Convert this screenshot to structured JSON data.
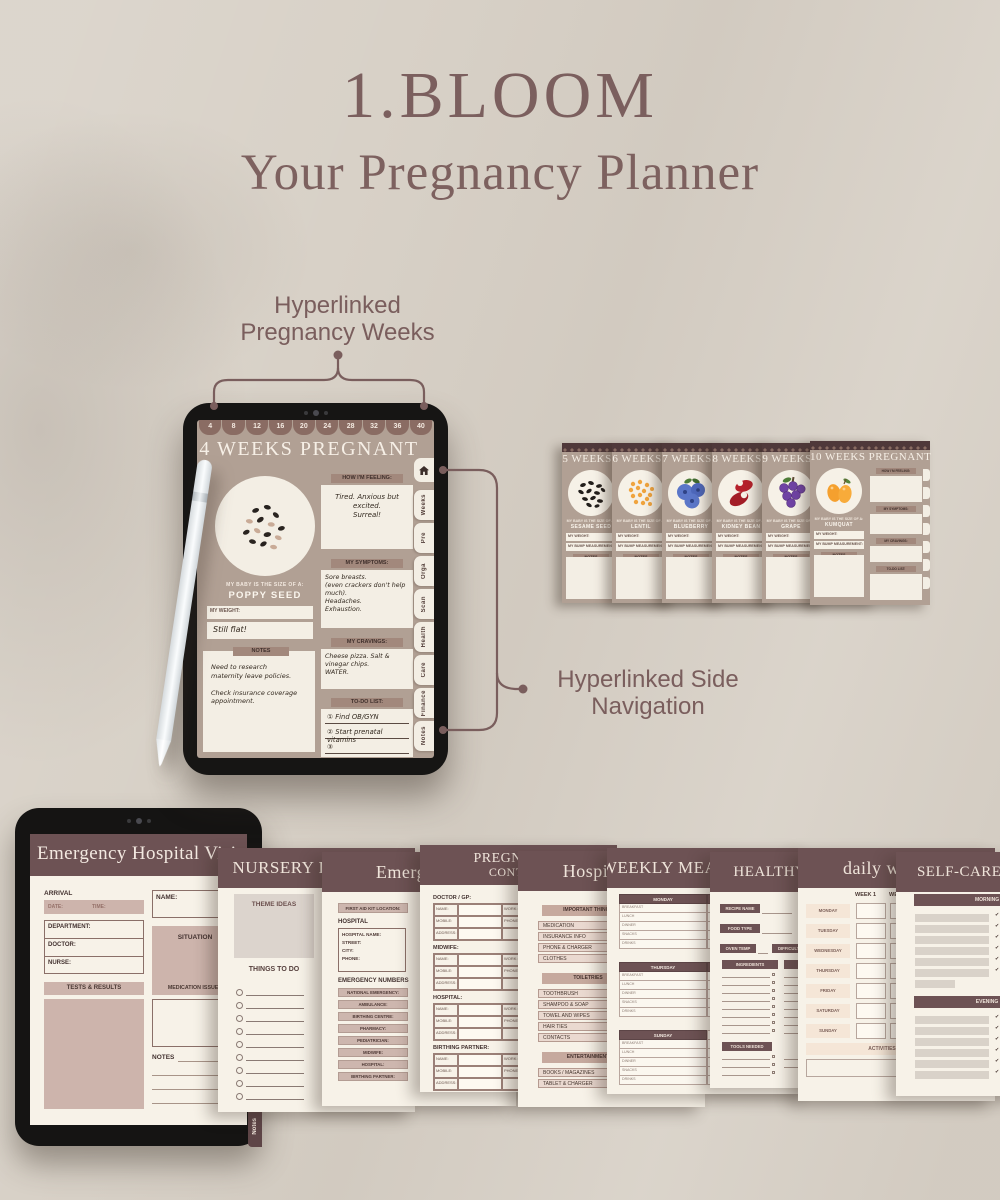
{
  "canvas": {
    "background": "#d8d1c7",
    "accent": "#7b5f5e"
  },
  "header": {
    "title": "1.BLOOM",
    "subtitle": "Your Pregnancy Planner"
  },
  "annotations": {
    "weeks": {
      "line1": "Hyperlinked",
      "line2": "Pregnancy Weeks"
    },
    "sidenav": {
      "line1": "Hyperlinked Side",
      "line2": "Navigation"
    }
  },
  "week_tablet": {
    "week_tabs": [
      "4",
      "8",
      "12",
      "16",
      "20",
      "24",
      "28",
      "32",
      "36",
      "40"
    ],
    "title": "4 WEEKS PREGNANT",
    "size_caption": "MY BABY IS THE SIZE OF A:",
    "size_value": "POPPY SEED",
    "weight_label": "MY WEIGHT:",
    "weight_note": "Still flat!",
    "notes_label": "NOTES",
    "notes_note": "Need to research\nmaternity leave policies.\n\nCheck insurance coverage\nappointment.",
    "feeling_label": "HOW I'M FEELING:",
    "feeling_note": "Tired. Anxious but excited.\nSurreal!",
    "symptoms_label": "MY SYMPTOMS:",
    "symptoms_note": "Sore breasts.\n(even crackers don't help much).\nHeadaches.\nExhaustion.",
    "cravings_label": "MY CRAVINGS:",
    "cravings_note": "Cheese pizza. Salt & vinegar chips.\nWATER.",
    "todo_label": "TO-DO LIST:",
    "todo_items": [
      "① Find OB/GYN",
      "② Start prenatal vitamins",
      "③"
    ],
    "side_tabs": [
      "Weeks",
      "Pre",
      "Orga",
      "Scan",
      "Health",
      "Care",
      "Finance",
      "Notes"
    ]
  },
  "week_cards": {
    "size_caption": "MY BABY IS THE SIZE OF A:",
    "weight_label": "MY WEIGHT:",
    "measure_label": "MY BUMP MEASUREMENT:",
    "notes_label": "NOTES",
    "cards": [
      {
        "title": "5 WEEKS PREGNANT",
        "size": "SESAME SEED"
      },
      {
        "title": "6 WEEKS PREGNANT",
        "size": "LENTIL"
      },
      {
        "title": "7 WEEKS PREGNANT",
        "size": "BLUEBERRY"
      },
      {
        "title": "8 WEEKS PREGNANT",
        "size": "KIDNEY BEAN"
      },
      {
        "title": "9 WEEKS PREGNANT",
        "size": "GRAPE"
      },
      {
        "title": "10 WEEKS PREGNANT",
        "size": "KUMQUAT"
      }
    ]
  },
  "emergency_tablet": {
    "title": "Emergency Hospital Visit",
    "arrival_label": "ARRIVAL",
    "date_label": "DATE:",
    "time_label": "TIME:",
    "fields": [
      "DEPARTMENT:",
      "DOCTOR:",
      "NURSE:"
    ],
    "name_label": "NAME:",
    "situation_label": "SITUATION",
    "tests_label": "TESTS & RESULTS",
    "medication_label": "MEDICATION ISSUED",
    "notes_label": "NOTES",
    "side_tab": "Notes"
  },
  "pages": {
    "nursery": {
      "title": "NURSERY PLANNER",
      "theme_label": "THEME IDEAS",
      "todo_label": "THINGS TO DO"
    },
    "emergency": {
      "title": "Emergency",
      "first_aid_label": "FIRST AID KIT LOCATION:",
      "hospital_label": "HOSPITAL",
      "hospital_fields": [
        "HOSPITAL NAME:",
        "STREET:",
        "CITY:",
        "PHONE:"
      ],
      "numbers_label": "EMERGENCY NUMBERS",
      "numbers": [
        "NATIONAL EMERGENCY:",
        "AMBULANCE:",
        "BIRTHING CENTRE:",
        "PHARMACY:",
        "PEDIATRICIAN:",
        "MIDWIFE:",
        "HOSPITAL:",
        "BIRTHING PARTNER:"
      ]
    },
    "contacts": {
      "title_line1": "PREGNANCY",
      "title_line2": "CONTACT",
      "sections": [
        "DOCTOR / GP:",
        "MIDWIFE:",
        "HOSPITAL:",
        "BIRTHING PARTNER:"
      ],
      "row_labels": [
        "NAME:",
        "MOBILE:",
        "ADDRESS:"
      ],
      "right_labels": [
        "WORK:",
        "PHONE:"
      ]
    },
    "hospital_bag": {
      "title": "Hospital bag",
      "groups": [
        {
          "label": "IMPORTANT THINGS",
          "items": [
            "MEDICATION",
            "INSURANCE INFO",
            "PHONE & CHARGER",
            "CLOTHES"
          ]
        },
        {
          "label": "TOILETRIES",
          "items": [
            "TOOTHBRUSH",
            "SHAMPOO & SOAP",
            "TOWEL AND WIPES",
            "HAIR TIES",
            "CONTACTS"
          ]
        },
        {
          "label": "ENTERTAINMENT",
          "items": [
            "BOOKS / MAGAZINES",
            "TABLET & CHARGER"
          ]
        }
      ]
    },
    "weekly_meal": {
      "title": "WEEKLY MEAL PLANNER",
      "day_pairs": [
        [
          "MONDAY",
          "TUESDAY"
        ],
        [
          "THURSDAY",
          "FRIDAY"
        ],
        [
          "SUNDAY",
          ""
        ]
      ],
      "rows": [
        "BREAKFAST",
        "LUNCH",
        "DINNER",
        "SNACKS",
        "DRINKS"
      ]
    },
    "recipes": {
      "title": "HEALTHY RECIPES",
      "name_label": "RECIPE NAME",
      "type_label": "FOOD TYPE",
      "oven_label": "OVEN TEMP",
      "difficulty_label": "DIFFICULTY",
      "ingredients_label": "INGREDIENTS",
      "tools_label": "TOOLS NEEDED"
    },
    "workout": {
      "title": "daily workout",
      "week1": "WEEK 1",
      "week2": "WEEK 2",
      "days": [
        "MONDAY",
        "TUESDAY",
        "WEDNESDAY",
        "THURSDAY",
        "FRIDAY",
        "SATURDAY",
        "SUNDAY"
      ],
      "activities_label": "ACTIVITIES"
    },
    "selfcare": {
      "title": "SELF-CARE ROUTINE",
      "morning_label": "MORNING ROUTINE",
      "evening_label": "EVENING ROUTINE"
    }
  }
}
